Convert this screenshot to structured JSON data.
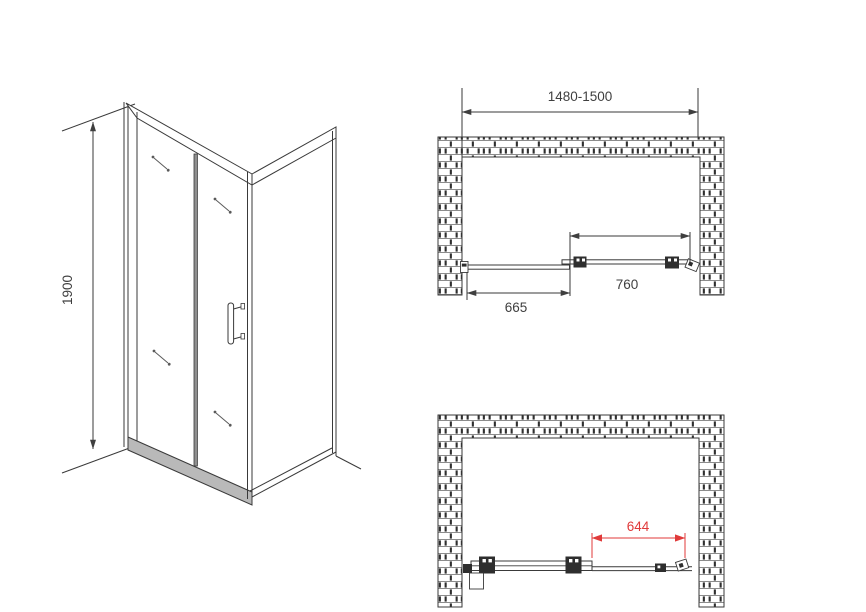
{
  "drawing": {
    "type": "shower-door-installation-diagram",
    "isometric": {
      "height_label": "1900"
    },
    "plan_closed": {
      "overall_width_label": "1480-1500",
      "door_width_label": "760",
      "fixed_panel_label": "665"
    },
    "plan_open": {
      "opening_width_label": "644"
    },
    "colors": {
      "line": "#3a3a3a",
      "dimension_red": "#e03a3a",
      "background": "#ffffff"
    }
  }
}
